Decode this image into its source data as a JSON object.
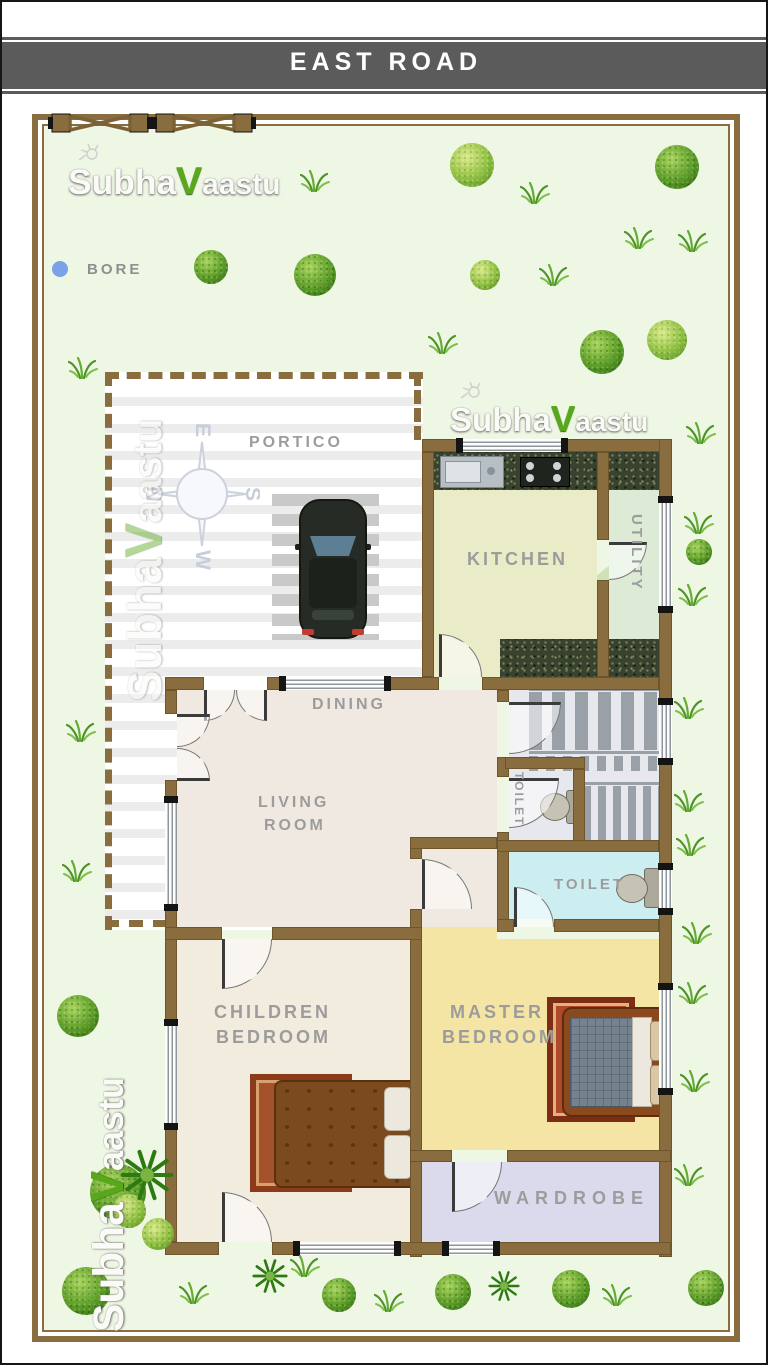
{
  "road": {
    "label": "EAST ROAD"
  },
  "bore": {
    "label": "BORE"
  },
  "brand": {
    "part1": "Subha",
    "part2": "V",
    "part3": "aastu",
    "full": "Subhavaastu"
  },
  "compass": {
    "north": "N",
    "east": "E",
    "south": "S",
    "west": "W"
  },
  "rooms": {
    "portico": "PORTICO",
    "kitchen": "KITCHEN",
    "utility": "UTILITY",
    "dining": "DINING",
    "living_line1": "LIVING",
    "living_line2": "ROOM",
    "toilet_upper": "TOILET",
    "toilet_lower": "TOILET",
    "master_line1": "MASTER",
    "master_line2": "BEDROOM",
    "children_line1": "CHILDREN",
    "children_line2": "BEDROOM",
    "wardrobe": "WARDROBE"
  },
  "colors": {
    "road": "#5b5b5b",
    "wall": "#8a6d3e",
    "plot_bg": "#eef6e4",
    "kitchen_floor": "#e9ecc6",
    "utility_floor": "#dcead6",
    "stairs_floor": "#e7e7ee",
    "toilet_floor": "#cdeef1",
    "master_floor": "#f5e5a4",
    "children_floor": "#f2ecdf",
    "living_floor": "#efe9e1",
    "wardrobe_floor": "#dadaec",
    "label_gray": "#9c9c9c",
    "bore_dot": "#7ba1e8",
    "tree_green": "#5a9c25"
  }
}
